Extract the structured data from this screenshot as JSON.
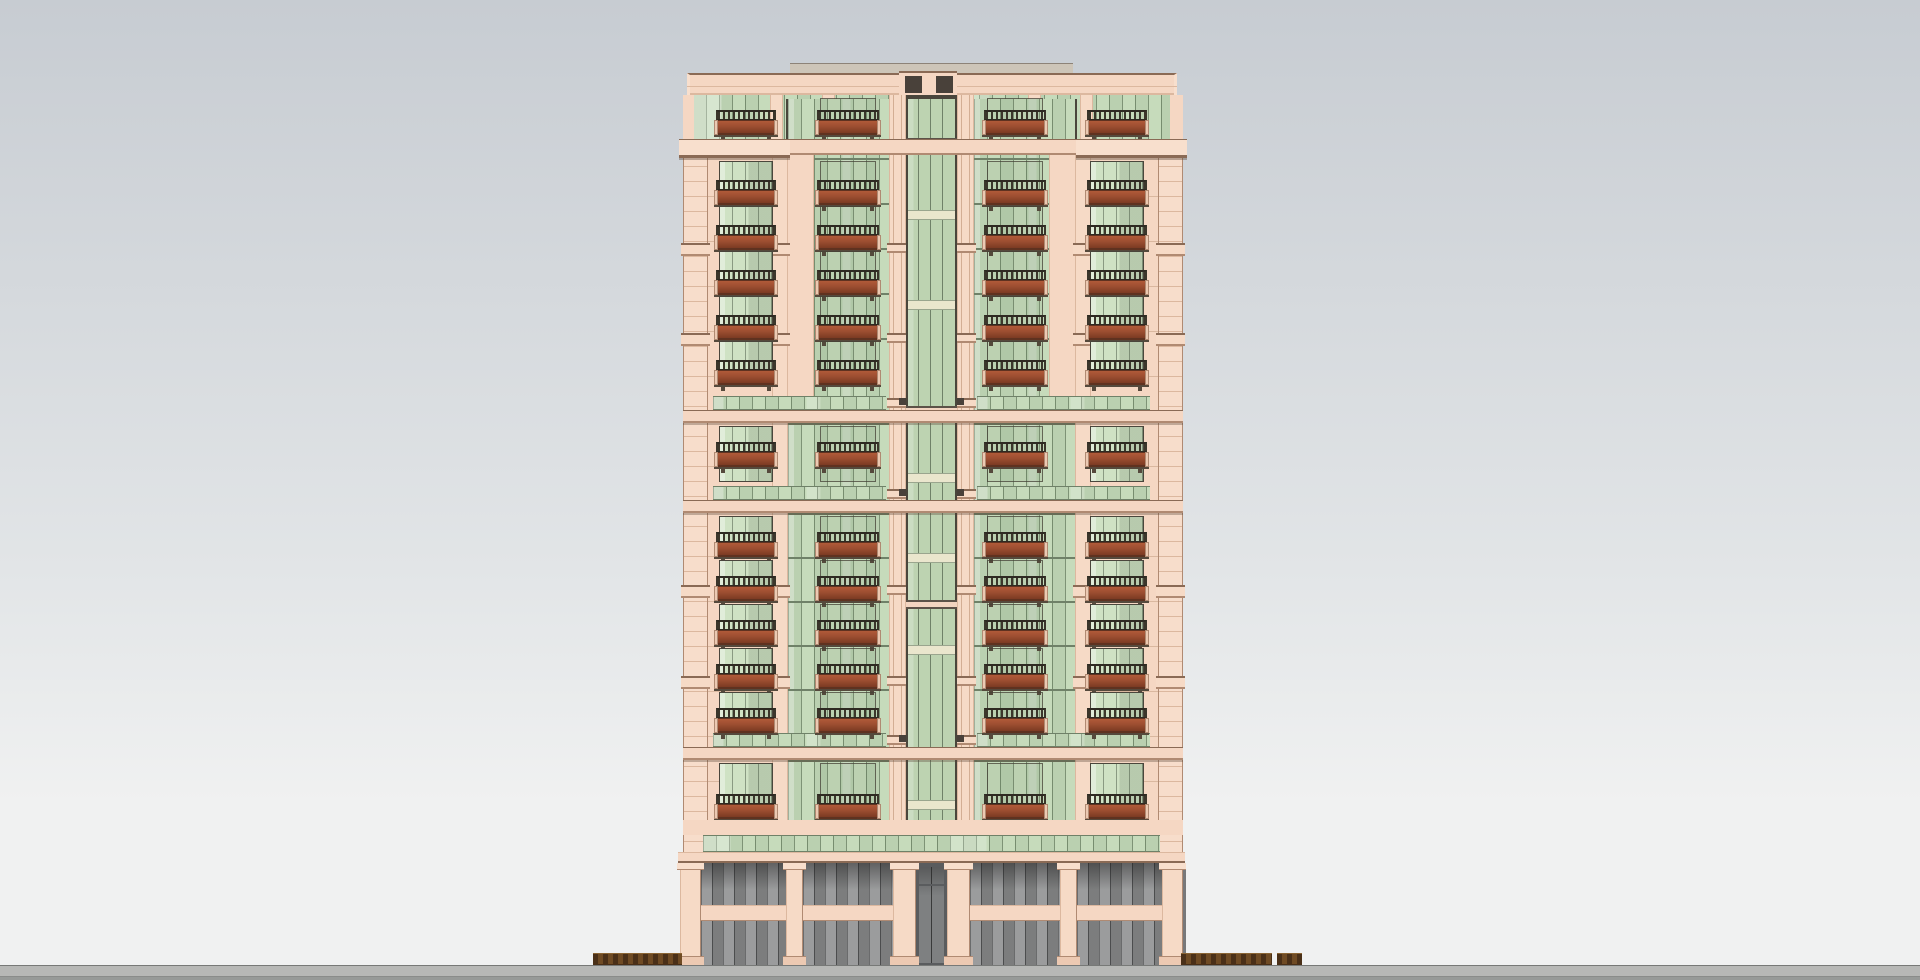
{
  "meta": {
    "type": "architectural-elevation-render",
    "visible_text": []
  },
  "palette": {
    "sky_top": "#c7ccd2",
    "sky_mid": "#e2e5e7",
    "sky_bottom": "#f0f1f1",
    "wall": "#f5d7c3",
    "wall_light": "#f8dfcd",
    "pier": "#f6dac6",
    "quoin": "#f7ddcb",
    "joint": "#dcb89f",
    "cornice_line": "#8a6a55",
    "cornice_shadow": "#b08a72",
    "edge_dark": "#6b5d52",
    "glass": "#c6dbbb",
    "glass_dark": "#b9d2ae",
    "glass_deep": "#bdd3b1",
    "glass_frame": "#4a463c",
    "glass_mullion": "#7e9376",
    "glass_line": "#6f8168",
    "window_glass": "#cfe2c4",
    "reflect": "#e9f1e0",
    "spandrel_pale": "#eae6cd",
    "spandrel_pale_line": "#9aa58e",
    "transom_cream": "#f2d4c0",
    "transom_edge": "#5c5248",
    "railing": "#3b362b",
    "railing_top": "#2e2a22",
    "planter_hi": "#b05a39",
    "planter": "#9d4e31",
    "planter_dark": "#7c3a23",
    "planter_edge": "#5f3220",
    "planter_cap": "#ecc9b2",
    "balcony_shadow": "#55493c",
    "slot_dark": "#49413a",
    "roof_sliver": "#cdc5b8",
    "roof_sliver_line": "#8d8378",
    "podium_backdrop": "#77787a",
    "podium_glass": "#909192",
    "podium_mullion": "#595a5b",
    "door_glass": "#7e8081",
    "door_frame": "#5a5c5e",
    "street_line": "#777977",
    "sidewalk": "#b7b8b6",
    "curb": "#8a8c8a",
    "road": "#979a98",
    "hedge_a": "#4a3018",
    "hedge_b": "#6f4b24",
    "hedge_top": "#8a6434"
  },
  "scene": {
    "canvas": {
      "w": 1920,
      "h": 980
    },
    "ground": {
      "line_y": 965,
      "sidewalk_h": 11,
      "curb_y": 976,
      "road_h": 4
    },
    "hedge_y": 953,
    "hedge_h": 12,
    "hedges": [
      {
        "x": 593,
        "w": 89
      },
      {
        "x": 1181,
        "w": 91
      },
      {
        "x": 1277,
        "w": 25
      }
    ],
    "building": {
      "left": 683,
      "right": 1183,
      "roof_sliver": {
        "x": 790,
        "y": 63,
        "w": 283,
        "h": 11
      },
      "parapet": {
        "x": 687,
        "y": 73,
        "w": 490,
        "h": 22,
        "groove_dy": 13
      },
      "roof_stack": {
        "x": 899,
        "y": 71,
        "w": 58,
        "h": 24,
        "slot_y": 76,
        "slot_h": 17,
        "slots": [
          {
            "x": 905,
            "w": 17
          },
          {
            "x": 936,
            "w": 17
          }
        ]
      },
      "penthouse": {
        "y": 95,
        "h": 44,
        "glass_x": 693,
        "glass_w": 478,
        "pilaster_w": 13,
        "pilasters": [
          770,
          822,
          1028,
          1080
        ],
        "end_walls": [
          {
            "x": 683,
            "w": 11
          },
          {
            "x": 1170,
            "w": 13
          }
        ],
        "tower": {
          "x": 899,
          "w": 59,
          "frame_w": 7,
          "header_h": 5
        }
      },
      "cornice1": {
        "y": 139,
        "h": 19,
        "mid_h": 16,
        "mid_x": 790,
        "mid_w": 286,
        "wings": [
          {
            "x": 679,
            "w": 111
          },
          {
            "x": 1076,
            "w": 111
          }
        ]
      },
      "wing_y": 152,
      "wing_h": 683,
      "wings": [
        {
          "x": 683,
          "w": 103
        },
        {
          "x": 1077,
          "w": 106
        }
      ],
      "quoin_y": 152,
      "quoin_h": 700,
      "quoins": [
        {
          "x": 683,
          "w": 25
        },
        {
          "x": 1158,
          "w": 25
        }
      ],
      "pilasters": [
        {
          "x": 772,
          "w": 16
        },
        {
          "x": 1075,
          "w": 16
        }
      ],
      "upper_infill_y": 155,
      "upper_infill_h": 241,
      "upper_infill": [
        {
          "x": 786,
          "w": 28
        },
        {
          "x": 1049,
          "w": 28
        }
      ],
      "ledge_ys": [
        243,
        333,
        585,
        676
      ],
      "bay_y": 99,
      "bay_h": 736,
      "glass_bays": [
        {
          "x": 786,
          "w": 105
        },
        {
          "x": 972,
          "w": 105
        }
      ],
      "center": {
        "pier_y": 95,
        "pier_h": 757,
        "piers": [
          {
            "x": 889,
            "w": 17
          },
          {
            "x": 957,
            "w": 17
          }
        ],
        "glass": {
          "x": 906,
          "y": 99,
          "w": 51,
          "h": 753
        },
        "mullions": [
          918,
          930,
          942
        ],
        "pale_spandrels": [
          210,
          300,
          473,
          553,
          645,
          800
        ],
        "cream_transoms": [
          138,
          406,
          500,
          600,
          748
        ],
        "block_ys": [
          398,
          489,
          735
        ],
        "pier_ledge_ys": [
          243,
          333,
          398,
          489,
          585,
          676,
          735
        ]
      },
      "floors": [
        {
          "y": 95,
          "h": 44,
          "dy": 15,
          "window": false
        },
        {
          "y": 158,
          "h": 45,
          "dy": 22,
          "window": true
        },
        {
          "y": 203,
          "h": 45,
          "dy": 22,
          "window": true
        },
        {
          "y": 248,
          "h": 45,
          "dy": 22,
          "window": true
        },
        {
          "y": 293,
          "h": 45,
          "dy": 22,
          "window": true
        },
        {
          "y": 338,
          "h": 45,
          "dy": 22,
          "window": true
        },
        {
          "y": 423,
          "h": 63,
          "dy": 19,
          "window": true
        },
        {
          "y": 513,
          "h": 44,
          "dy": 19,
          "window": true
        },
        {
          "y": 557,
          "h": 44,
          "dy": 19,
          "window": true
        },
        {
          "y": 601,
          "h": 44,
          "dy": 19,
          "window": true
        },
        {
          "y": 645,
          "h": 44,
          "dy": 19,
          "window": true
        },
        {
          "y": 689,
          "h": 44,
          "dy": 19,
          "window": true
        },
        {
          "y": 760,
          "h": 60,
          "dy": 34,
          "window": true
        }
      ],
      "stacks": {
        "wing": [
          {
            "x": 719,
            "w": 54
          },
          {
            "x": 1090,
            "w": 54
          }
        ],
        "bay": [
          {
            "x": 820,
            "w": 56
          },
          {
            "x": 987,
            "w": 56
          }
        ]
      },
      "band_green_h": 14,
      "band_cream_h": 13,
      "bands": [
        {
          "gy": 396,
          "cy": 410
        },
        {
          "gy": 486,
          "cy": 500
        },
        {
          "gy": 733,
          "cy": 747
        }
      ],
      "band_green_spans": [
        {
          "x": 713,
          "w": 173
        },
        {
          "x": 977,
          "w": 173
        }
      ],
      "lower_wall_strip": {
        "y": 820,
        "h": 15
      },
      "loggia": {
        "x": 703,
        "w": 457,
        "y": 835,
        "h": 17
      },
      "slab": {
        "x": 678,
        "w": 507,
        "y": 852,
        "h": 11
      },
      "podium": {
        "y": 863,
        "h": 102,
        "piers": [
          {
            "x": 680,
            "w": 21
          },
          {
            "x": 786,
            "w": 17
          },
          {
            "x": 893,
            "w": 23
          },
          {
            "x": 947,
            "w": 23
          },
          {
            "x": 1060,
            "w": 17
          },
          {
            "x": 1162,
            "w": 21
          }
        ],
        "glass": [
          {
            "x": 701,
            "w": 85
          },
          {
            "x": 803,
            "w": 90
          },
          {
            "x": 970,
            "w": 90
          },
          {
            "x": 1077,
            "w": 85
          }
        ],
        "spandrel_y": 905,
        "spandrel_h": 16,
        "door": {
          "x": 916,
          "w": 31,
          "transom_dy": 21
        }
      }
    }
  }
}
